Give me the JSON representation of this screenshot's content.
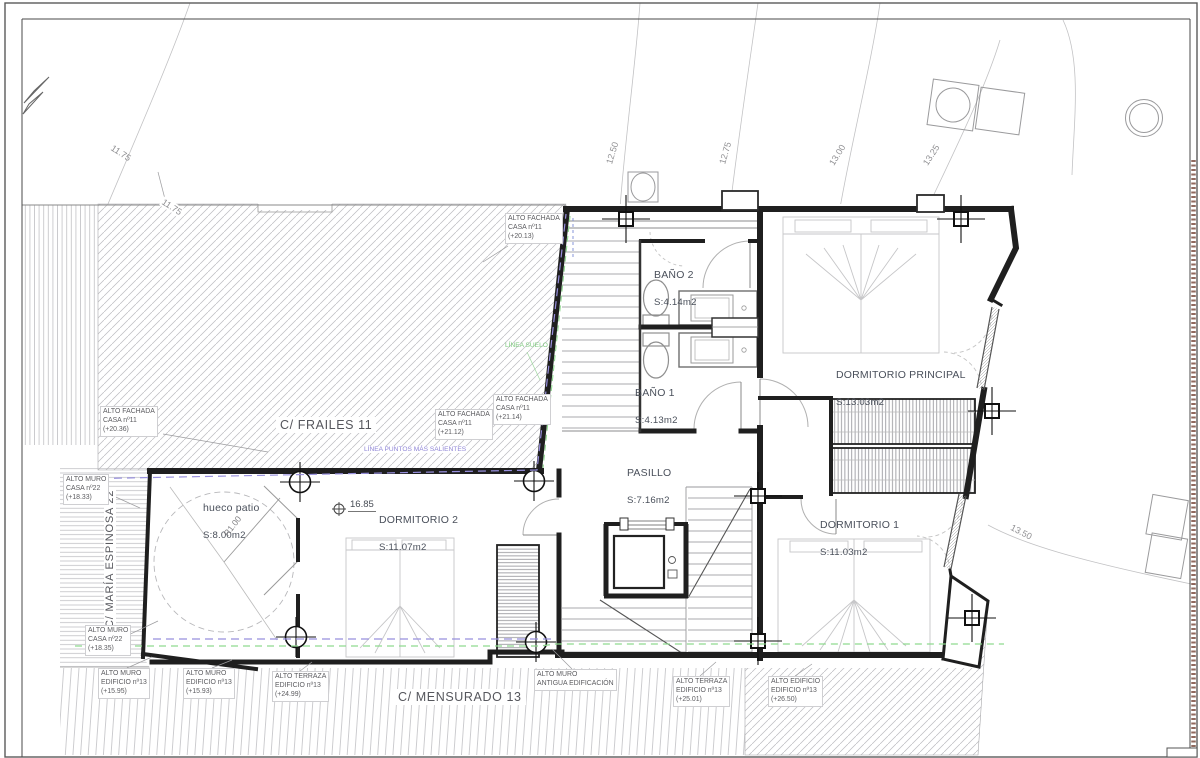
{
  "streets": {
    "top": "C/ FRAILES 11",
    "left": "C/ MARÍA ESPINOSA 22",
    "bottom": "C/ MENSURADO 13"
  },
  "rooms": {
    "bano2": {
      "name": "BAÑO 2",
      "area": "S:4.14m2"
    },
    "bano1": {
      "name": "BAÑO 1",
      "area": "S:4.13m2"
    },
    "principal": {
      "name": "DORMITORIO PRINCIPAL",
      "area": "S:13.03m2"
    },
    "pasillo": {
      "name": "PASILLO",
      "area": "S:7.16m2"
    },
    "dorm1": {
      "name": "DORMITORIO 1",
      "area": "S:11.03m2"
    },
    "dorm2": {
      "name": "DORMITORIO 2",
      "area": "S:11.07m2"
    },
    "patio": {
      "name": "hueco patio",
      "area": "S:8.00m2"
    }
  },
  "levels": {
    "floor": "16.85",
    "radius": "R1.00"
  },
  "contours": [
    "11.75",
    "11.75",
    "12.50",
    "12.75",
    "13.00",
    "13.25",
    "13.50"
  ],
  "annotations": [
    {
      "text": "ALTO FACHADA\nCASA nº11\n(+20.13)"
    },
    {
      "text": "ALTO FACHADA\nCASA nº11\n(+20.36)"
    },
    {
      "text": "ALTO FACHADA\nCASA nº11\n(+21.14)"
    },
    {
      "text": "ALTO FACHADA\nCASA nº11\n(+21.12)"
    },
    {
      "text": "ALTO MURO\nCASA nº22\n(+18.33)"
    },
    {
      "text": "ALTO MURO\nCASA nº22\n(+18.35)"
    },
    {
      "text": "ALTO MURO\nEDIFICIO nº13\n(+15.95)"
    },
    {
      "text": "ALTO MURO\nEDIFICIO nº13\n(+15.93)"
    },
    {
      "text": "ALTO TERRAZA\nEDIFICIO nº13\n(+24.99)"
    },
    {
      "text": "ALTO MURO\nANTIGUA EDIFICACIÓN"
    },
    {
      "text": "ALTO TERRAZA\nEDIFICIO nº13\n(+25.01)"
    },
    {
      "text": "ALTO EDIFICIO\nEDIFICIO nº13\n(+26.50)"
    }
  ],
  "reference_lines": {
    "salientes": {
      "label": "LÍNEA PUNTOS MÁS SALIENTES",
      "color": "#8f85d6"
    },
    "suelo": {
      "label": "LÍNEA SUELO",
      "color": "#7cc87c"
    }
  }
}
